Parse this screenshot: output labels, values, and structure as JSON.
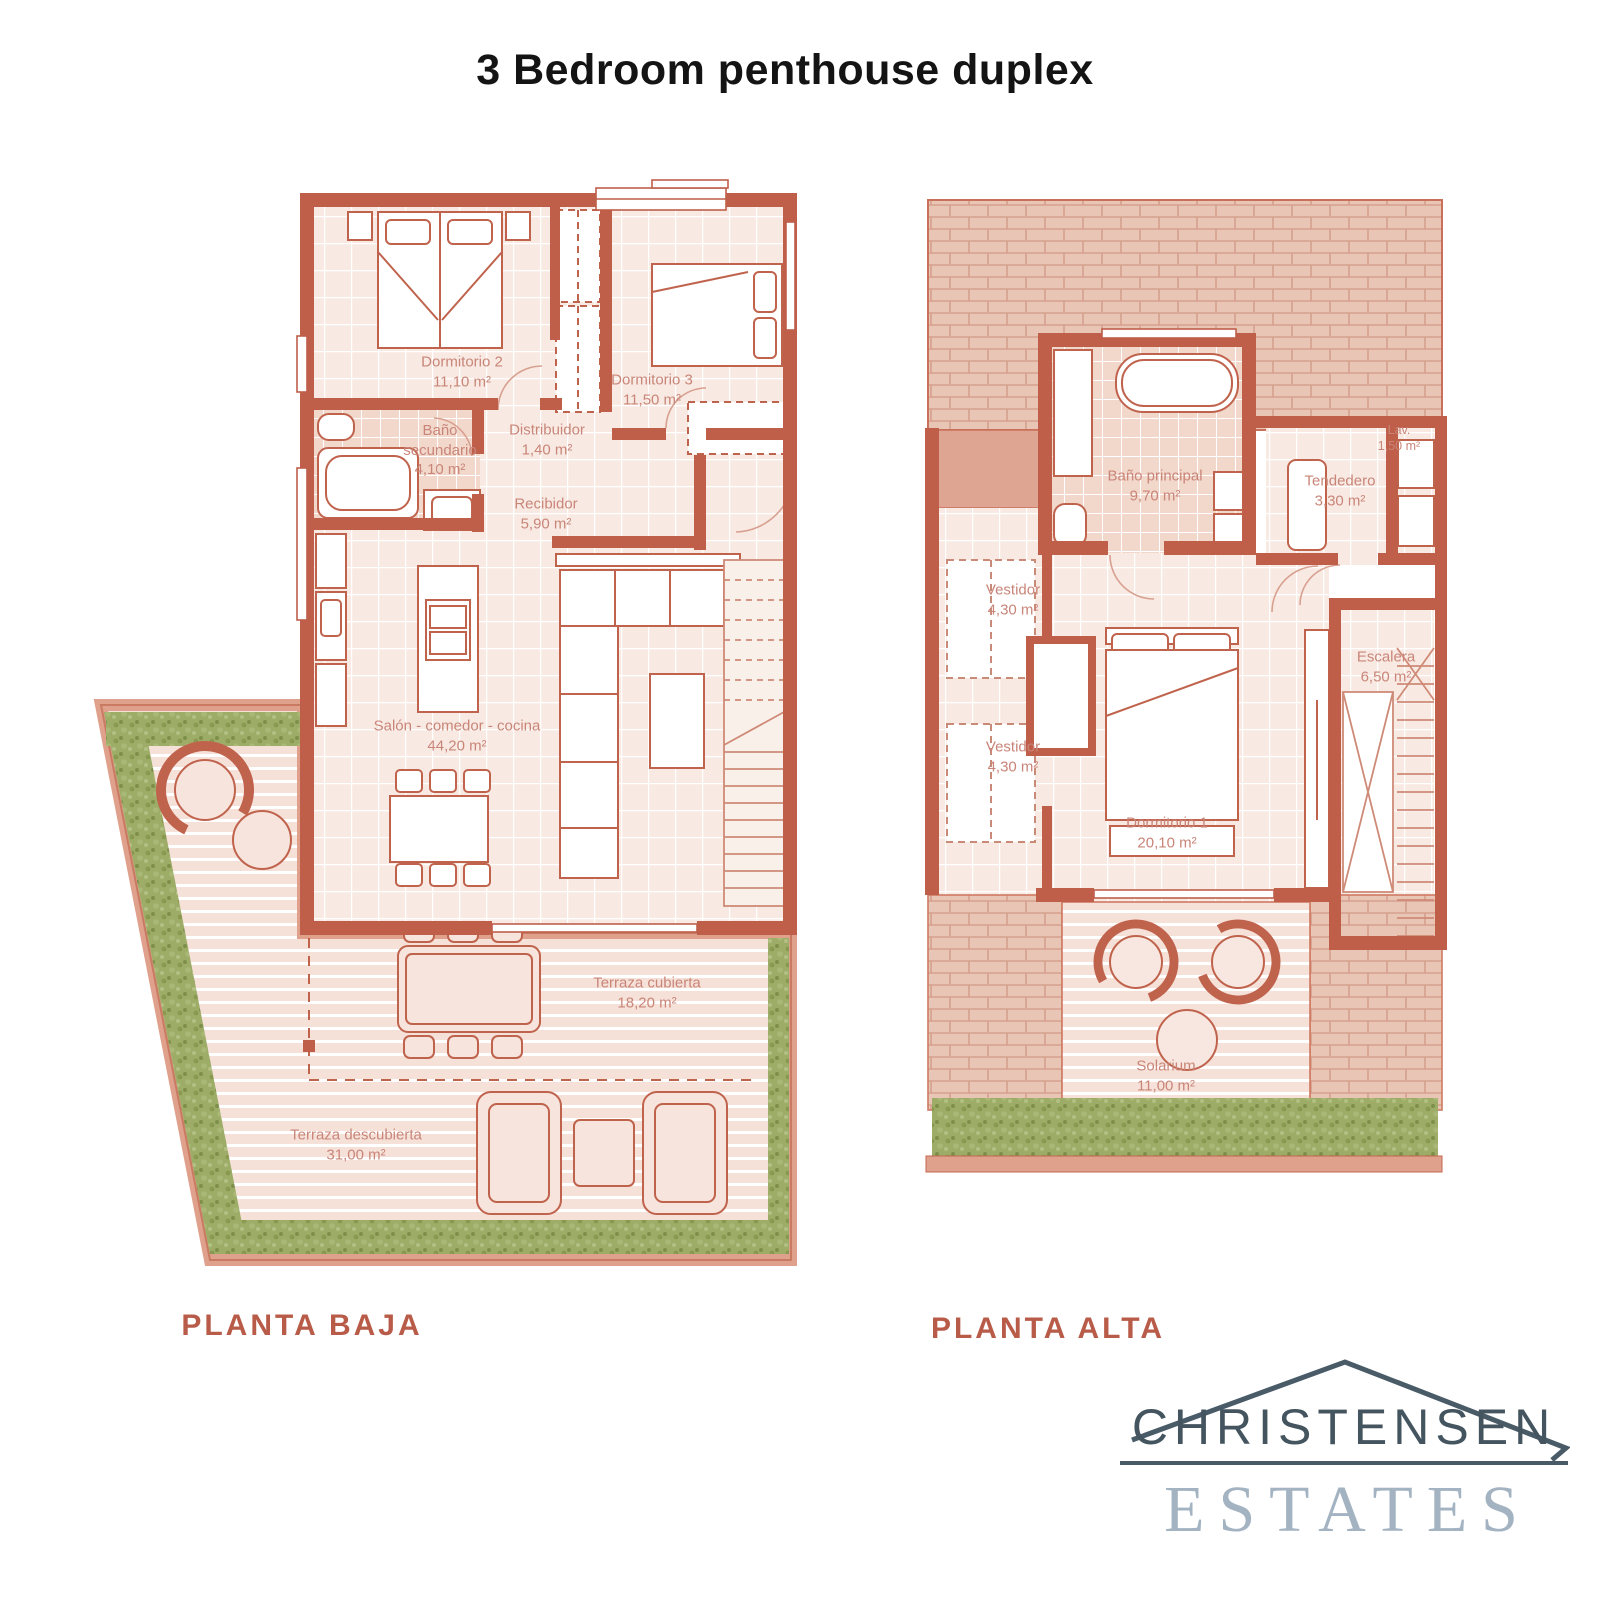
{
  "title": "3 Bedroom penthouse duplex",
  "floors": {
    "planta_baja": {
      "label": "PLANTA BAJA",
      "rooms": [
        {
          "name": "Dormitorio 2",
          "area": "11,10 m²"
        },
        {
          "name": "Dormitorio 3",
          "area": "11,50 m²"
        },
        {
          "name": "Baño secundario",
          "area": "4,10 m²"
        },
        {
          "name": "Distribuidor",
          "area": "1,40 m²"
        },
        {
          "name": "Recibidor",
          "area": "5,90 m²"
        },
        {
          "name": "Salón - comedor - cocina",
          "area": "44,20 m²"
        },
        {
          "name": "Terraza cubierta",
          "area": "18,20 m²"
        },
        {
          "name": "Terraza descubierta",
          "area": "31,00 m²"
        }
      ]
    },
    "planta_alta": {
      "label": "PLANTA ALTA",
      "rooms": [
        {
          "name": "Baño principal",
          "area": "9,70 m²"
        },
        {
          "name": "Lav.",
          "area": "1,50 m²"
        },
        {
          "name": "Tendedero",
          "area": "3,30 m²"
        },
        {
          "name": "Vestidor",
          "area": "4,30 m²"
        },
        {
          "name": "Vestidor",
          "area": "4,30 m²"
        },
        {
          "name": "Escalera",
          "area": "6,50 m²"
        },
        {
          "name": "Dormitorio 1",
          "area": "20,10 m²"
        },
        {
          "name": "Solarium",
          "area": "11,00 m²"
        }
      ]
    }
  },
  "logo": {
    "line1": "CHRISTENSEN",
    "line2": "ESTATES"
  },
  "colors": {
    "wall": "#bf5f4a",
    "hedge_green": "#9dad68",
    "caption_accent": "#b85c49",
    "room_label": "#c98578",
    "logo_primary": "#4a5b68",
    "logo_secondary": "#a3b3c1"
  }
}
